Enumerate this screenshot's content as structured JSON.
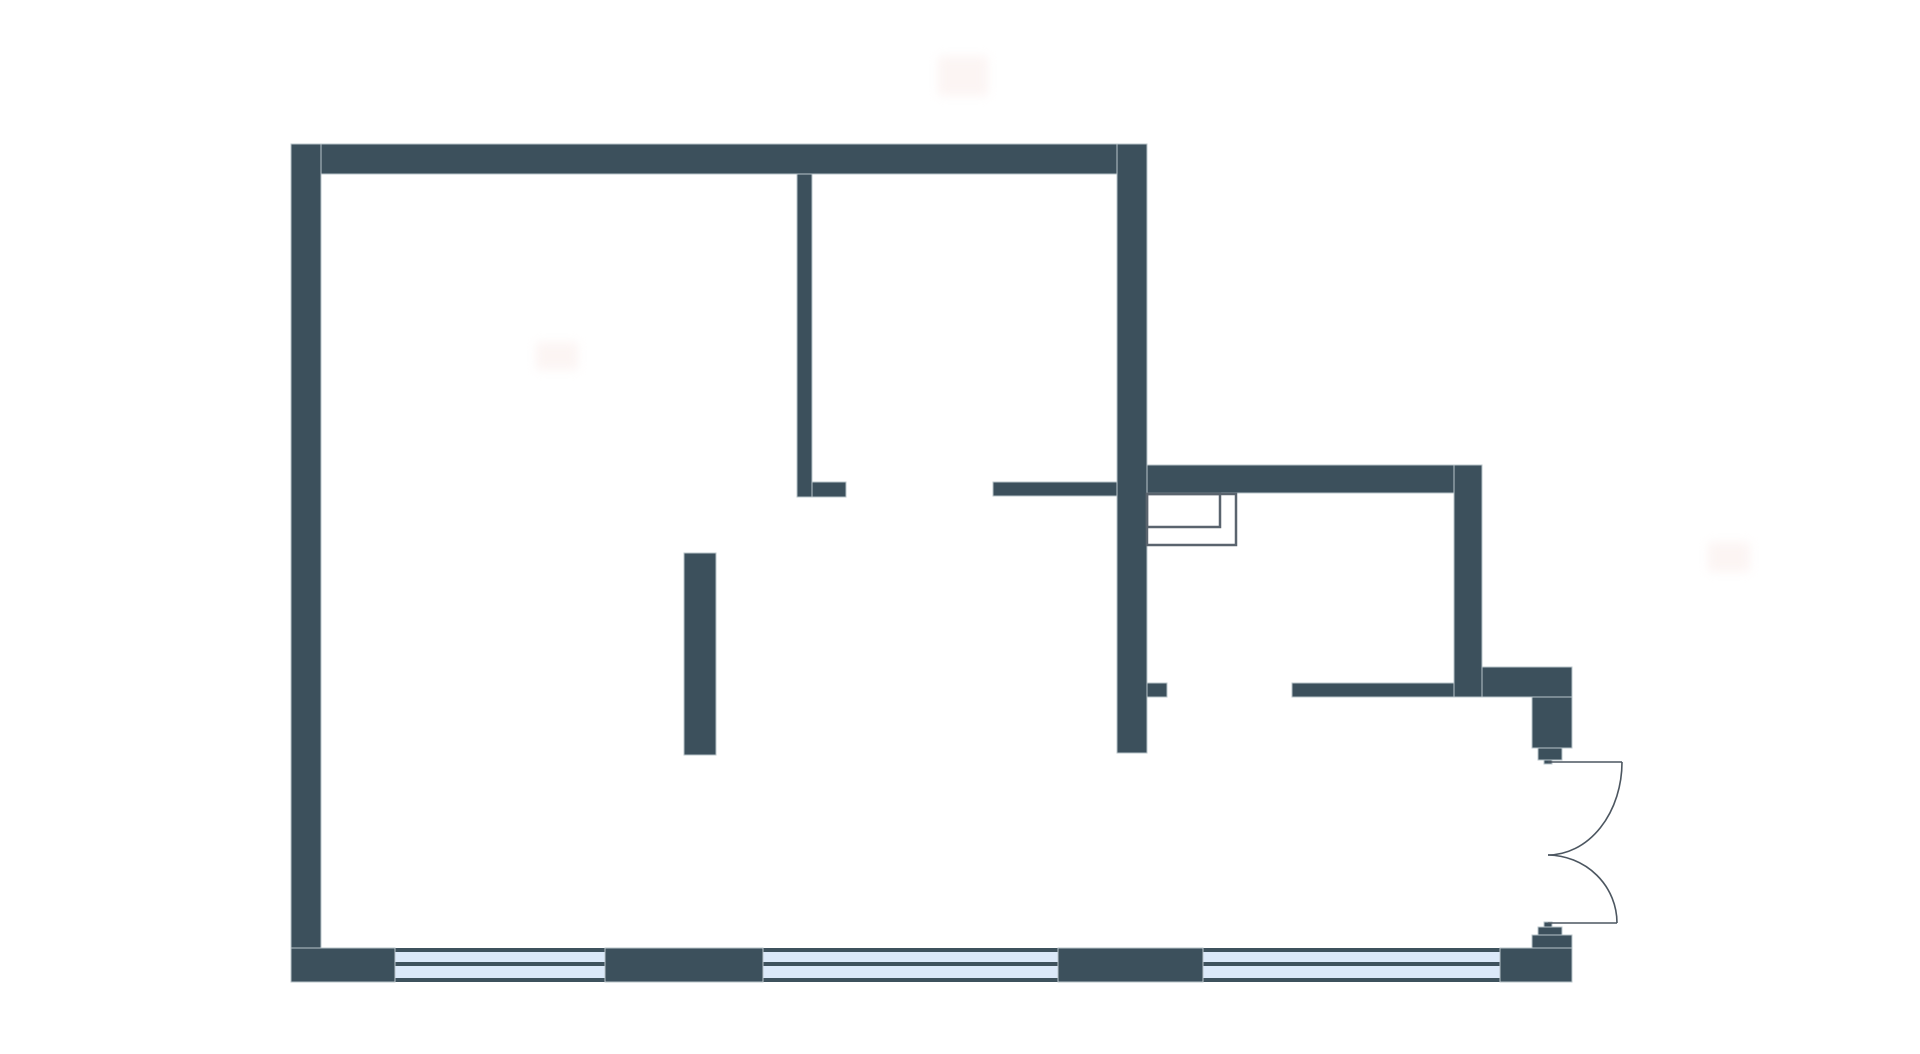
{
  "canvas": {
    "width": 1920,
    "height": 1054,
    "background_color": "#ffffff"
  },
  "palette": {
    "wall_fill": "#3c505c",
    "wall_edge": "#b9c4ca",
    "thin_line": "#5a646e",
    "window_fill": "#dbe9f9",
    "window_line": "#3e525d",
    "door_line": "#4c5660",
    "smudge_fill": "#f9e9e6"
  },
  "floor_plan": {
    "walls": [
      {
        "name": "top-wall",
        "x": 291,
        "y": 144,
        "w": 856,
        "h": 30
      },
      {
        "name": "left-wall",
        "x": 291,
        "y": 144,
        "w": 30,
        "h": 838
      },
      {
        "name": "right-wall",
        "x": 1117,
        "y": 144,
        "w": 30,
        "h": 609
      },
      {
        "name": "interior-wall-vertical",
        "x": 797,
        "y": 174,
        "w": 15,
        "h": 323
      },
      {
        "name": "interior-wall-foot",
        "x": 812,
        "y": 482,
        "w": 34,
        "h": 15
      },
      {
        "name": "interior-wall-stub",
        "x": 993,
        "y": 482,
        "w": 124,
        "h": 14
      },
      {
        "name": "annex-top-wall",
        "x": 1147,
        "y": 465,
        "w": 335,
        "h": 28
      },
      {
        "name": "annex-right-wall",
        "x": 1454,
        "y": 465,
        "w": 28,
        "h": 232
      },
      {
        "name": "annex-corner-band",
        "x": 1482,
        "y": 667,
        "w": 90,
        "h": 30
      },
      {
        "name": "right-wall-stub",
        "x": 1147,
        "y": 683,
        "w": 20,
        "h": 14
      },
      {
        "name": "hall-wall",
        "x": 1292,
        "y": 683,
        "w": 162,
        "h": 14
      },
      {
        "name": "door-jamb-top-block",
        "x": 1532,
        "y": 697,
        "w": 40,
        "h": 51
      },
      {
        "name": "door-jamb-top-step",
        "x": 1538,
        "y": 748,
        "w": 24,
        "h": 12
      },
      {
        "name": "door-jamb-top-nub",
        "x": 1544,
        "y": 760,
        "w": 8,
        "h": 4
      },
      {
        "name": "door-jamb-bottom-nub",
        "x": 1544,
        "y": 922,
        "w": 8,
        "h": 5
      },
      {
        "name": "door-jamb-bottom-step",
        "x": 1538,
        "y": 927,
        "w": 24,
        "h": 8
      },
      {
        "name": "door-jamb-bottom-block",
        "x": 1532,
        "y": 935,
        "w": 40,
        "h": 47
      },
      {
        "name": "partition-island",
        "x": 684,
        "y": 553,
        "w": 32,
        "h": 202
      },
      {
        "name": "bottom-wall-segment-1",
        "x": 291,
        "y": 948,
        "w": 104,
        "h": 34
      },
      {
        "name": "bottom-wall-segment-2",
        "x": 605,
        "y": 948,
        "w": 158,
        "h": 34
      },
      {
        "name": "bottom-wall-segment-3",
        "x": 1058,
        "y": 948,
        "w": 145,
        "h": 34
      },
      {
        "name": "bottom-wall-segment-4",
        "x": 1500,
        "y": 948,
        "w": 72,
        "h": 34
      }
    ],
    "windows": [
      {
        "name": "window-1",
        "x": 395,
        "y": 948,
        "w": 210,
        "h": 34
      },
      {
        "name": "window-2",
        "x": 763,
        "y": 948,
        "w": 295,
        "h": 34
      },
      {
        "name": "window-3",
        "x": 1203,
        "y": 948,
        "w": 297,
        "h": 34
      }
    ],
    "window_line_thickness": 4,
    "shaft_outlines": [
      {
        "name": "shaft-outline-inner",
        "x": 1147,
        "y": 494,
        "w": 73,
        "h": 33
      },
      {
        "name": "shaft-outline-outer",
        "x": 1147,
        "y": 494,
        "w": 89,
        "h": 51
      }
    ],
    "doors": {
      "leaves": [
        {
          "name": "door-leaf-top",
          "x1": 1548,
          "y1": 762,
          "x2": 1622,
          "y2": 762
        },
        {
          "name": "door-leaf-bottom",
          "x1": 1548,
          "y1": 923,
          "x2": 1617,
          "y2": 923
        }
      ],
      "swings": [
        {
          "name": "door-swing-top",
          "path": "M 1622 762 A 74 93 0 0 1 1548 855"
        },
        {
          "name": "door-swing-bottom",
          "path": "M 1548 855 A 70 68 0 0 1 1617 923"
        }
      ]
    },
    "smudges": [
      {
        "name": "smudge-1",
        "x": 938,
        "y": 56,
        "w": 50,
        "h": 40
      },
      {
        "name": "smudge-2",
        "x": 536,
        "y": 342,
        "w": 42,
        "h": 28
      },
      {
        "name": "smudge-3",
        "x": 1708,
        "y": 542,
        "w": 42,
        "h": 30
      }
    ]
  }
}
